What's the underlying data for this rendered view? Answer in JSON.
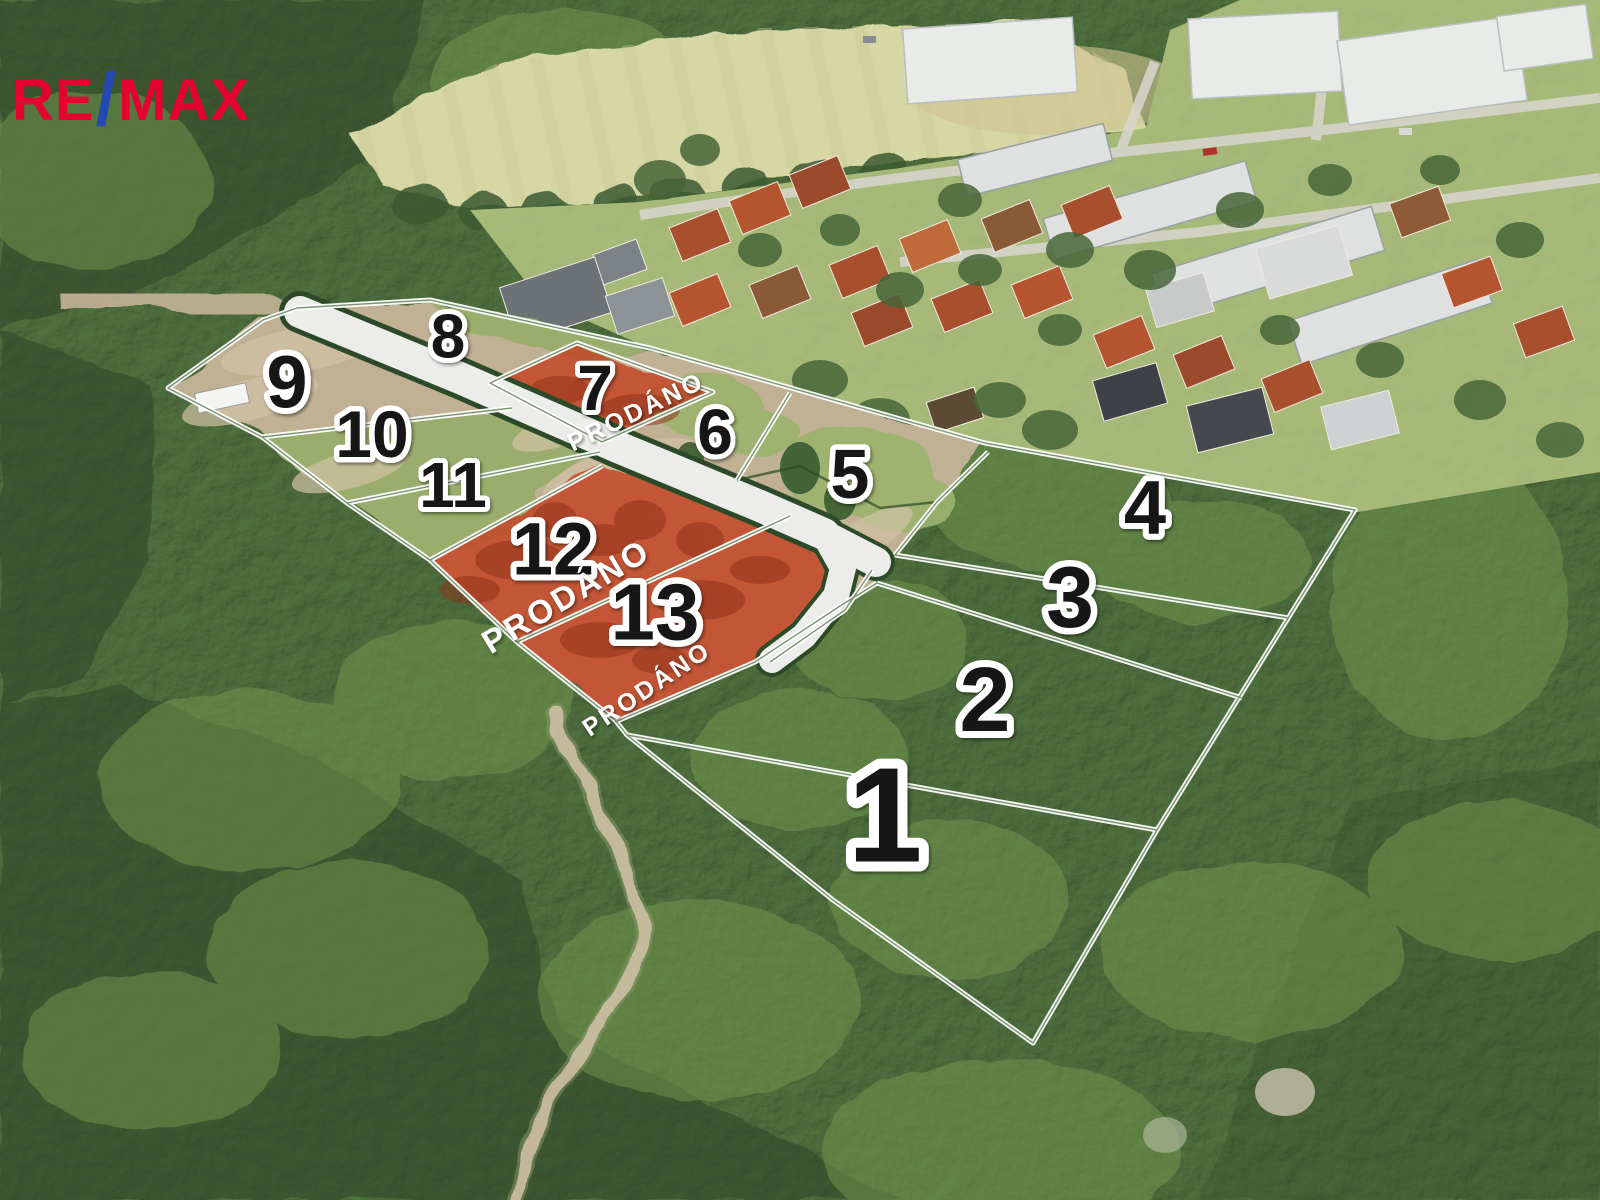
{
  "logo": {
    "re": "RE",
    "slash": "/",
    "max": "MAX"
  },
  "sold_label": "PRODÁNO",
  "parcels": [
    {
      "num": "1",
      "sold": false
    },
    {
      "num": "2",
      "sold": false
    },
    {
      "num": "3",
      "sold": false
    },
    {
      "num": "4",
      "sold": false
    },
    {
      "num": "5",
      "sold": false
    },
    {
      "num": "6",
      "sold": false
    },
    {
      "num": "7",
      "sold": true
    },
    {
      "num": "8",
      "sold": false
    },
    {
      "num": "9",
      "sold": false
    },
    {
      "num": "10",
      "sold": false
    },
    {
      "num": "11",
      "sold": false
    },
    {
      "num": "12",
      "sold": true
    },
    {
      "num": "13",
      "sold": true
    }
  ],
  "colors": {
    "sold_overlay": "#c2492a",
    "boundary_line": "#ffffff",
    "number_fill": "#161616",
    "number_halo": "#ffffff",
    "logo_red": "#e4032e",
    "logo_blue": "#2449b0",
    "road": "#ececea",
    "road_edge": "#2c4a27"
  }
}
